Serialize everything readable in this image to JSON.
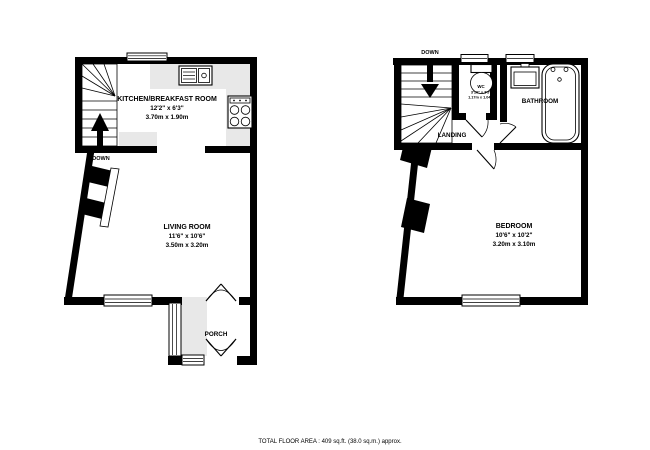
{
  "colors": {
    "wall": "#000000",
    "counter": "#e8e8e8",
    "background": "#ffffff"
  },
  "ground_floor": {
    "stairs_label": "DOWN",
    "kitchen": {
      "name": "KITCHEN/BREAKFAST ROOM",
      "size_imperial": "12'2\" x 6'3\"",
      "size_metric": "3.70m x 1.90m"
    },
    "living_room": {
      "name": "LIVING ROOM",
      "size_imperial": "11'6\" x 10'6\"",
      "size_metric": "3.50m x 3.20m"
    },
    "porch": {
      "name": "PORCH"
    }
  },
  "first_floor": {
    "stairs_label": "DOWN",
    "wc": {
      "name": "WC",
      "size_imperial": "3'10\" x 3'5\"",
      "size_metric": "1.17m x 1.04m"
    },
    "bathroom": {
      "name": "BATHROOM"
    },
    "landing": {
      "name": "LANDING"
    },
    "bedroom": {
      "name": "BEDROOM",
      "size_imperial": "10'6\" x 10'2\"",
      "size_metric": "3.20m x 3.10m"
    }
  },
  "footer": {
    "total_area": "TOTAL FLOOR AREA : 409 sq.ft. (38.0 sq.m.) approx."
  }
}
